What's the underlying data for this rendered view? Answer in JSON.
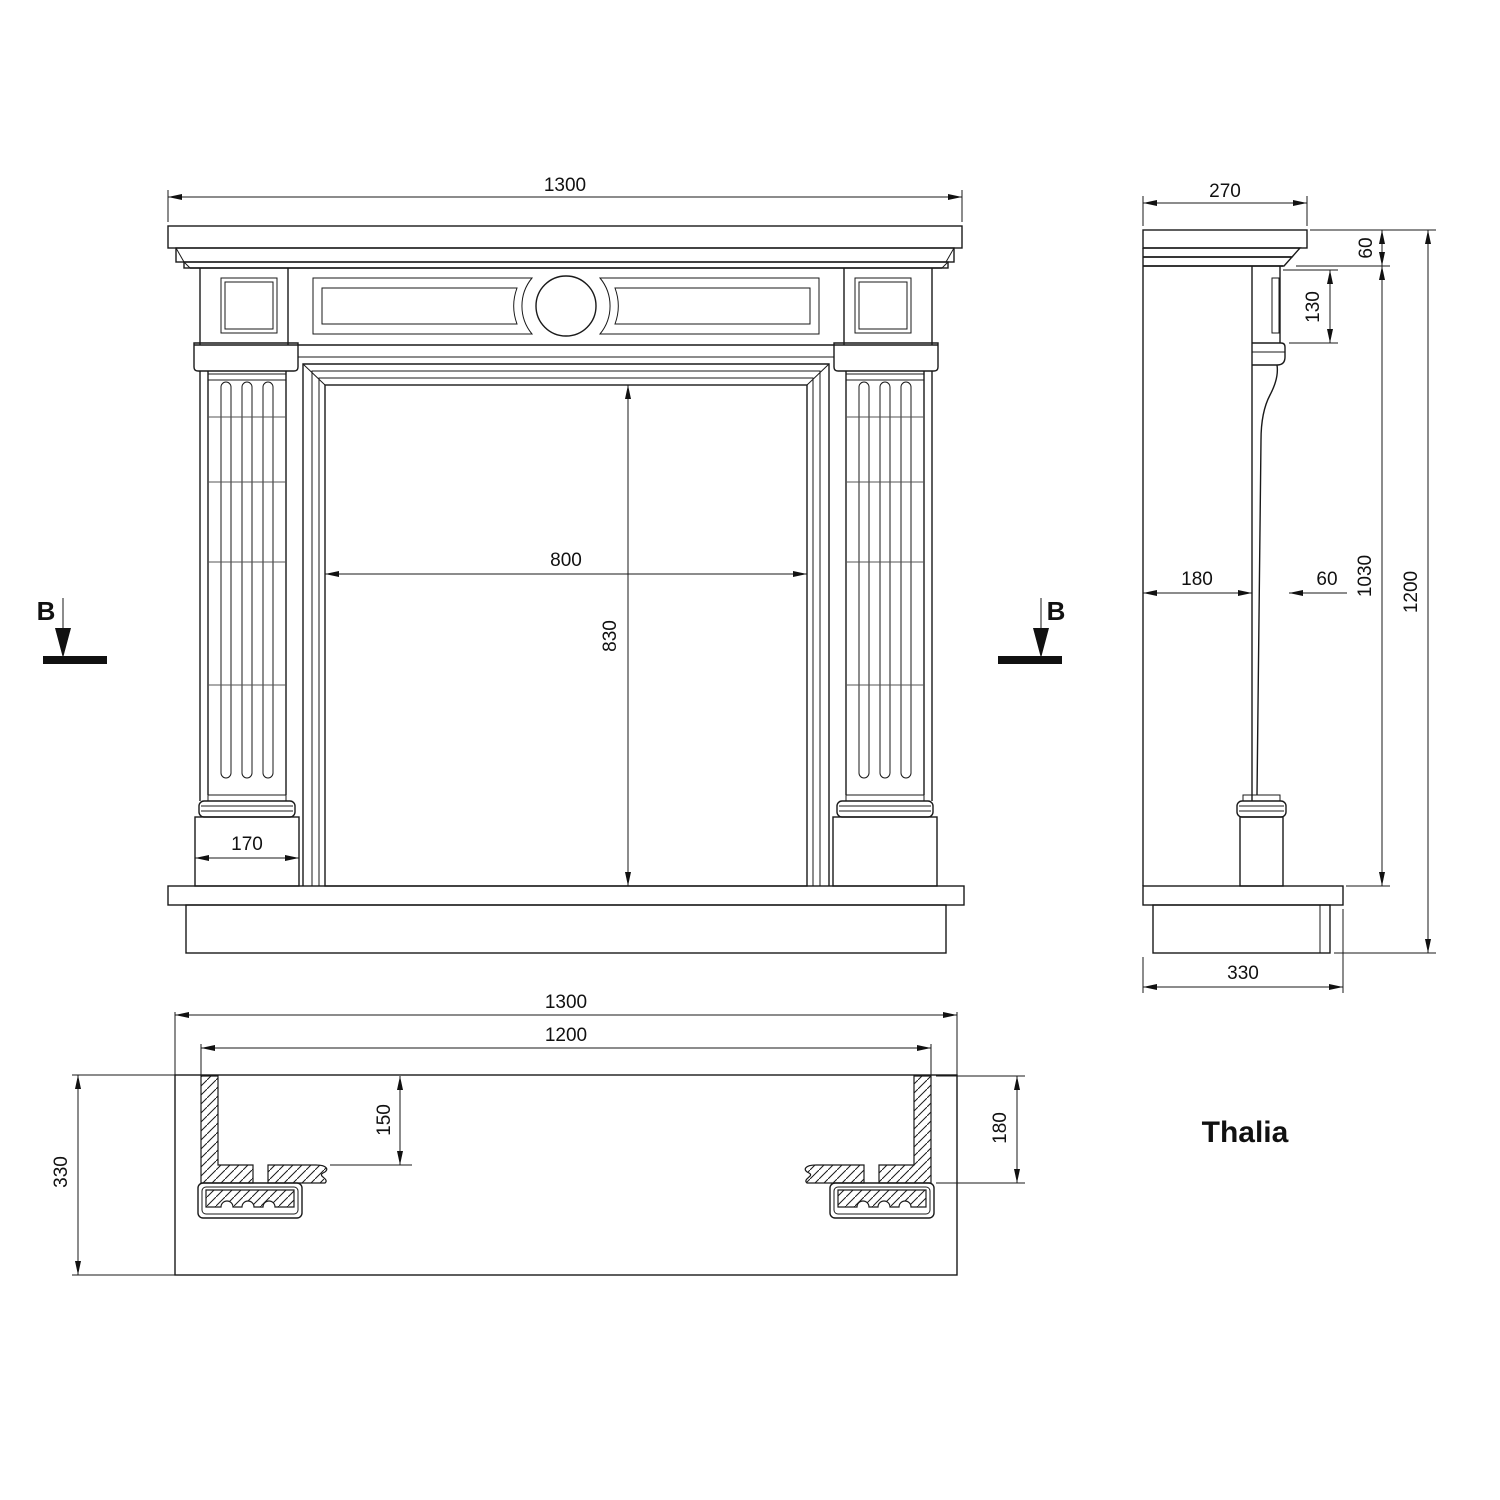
{
  "title": {
    "product_name": "Thalia"
  },
  "section": {
    "label": "B"
  },
  "front": {
    "overall_width": "1300",
    "opening_width": "800",
    "opening_height": "830",
    "plinth_width": "170"
  },
  "side": {
    "shelf_depth": "270",
    "shelf_height": "60",
    "frieze_height": "130",
    "wall_to_column": "180",
    "column_depth": "60",
    "column_zone_height": "1030",
    "overall_height": "1200",
    "base_depth": "330"
  },
  "plan": {
    "overall_width": "1300",
    "inner_width": "1200",
    "wall_return": "150",
    "end_wall_depth": "180",
    "base_depth": "330"
  }
}
